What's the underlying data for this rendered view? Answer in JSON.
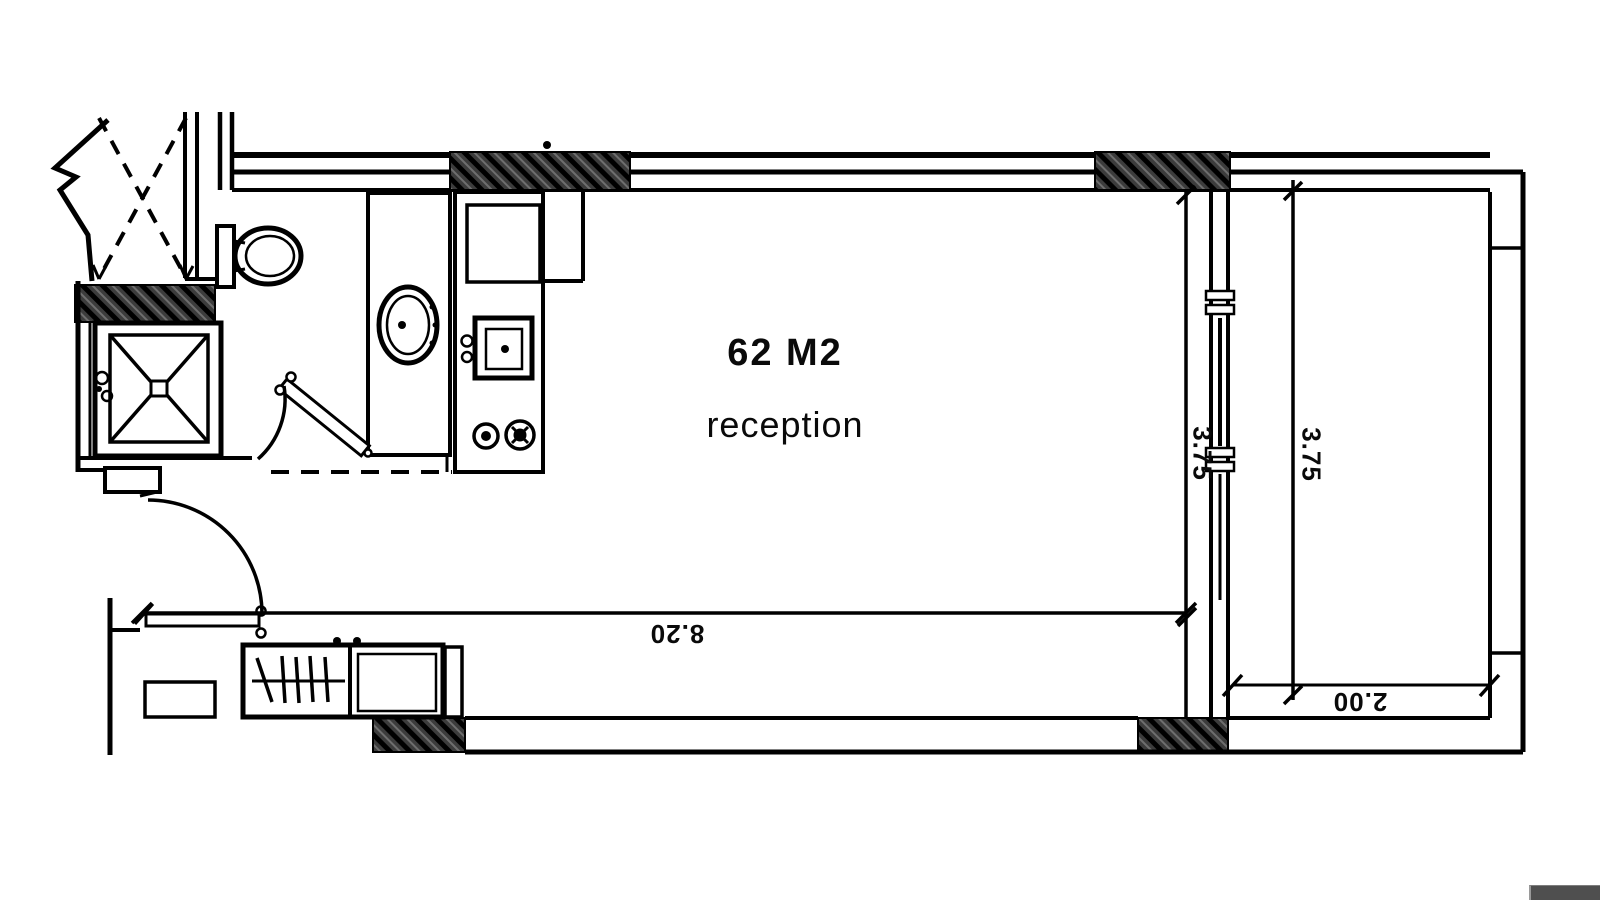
{
  "page": {
    "paper_color": "#ffffff",
    "line_color": "#000000",
    "scrollbar_color": "#4f4f4f"
  },
  "plan": {
    "area_label": "62 M2",
    "room_name": "reception",
    "dimensions": {
      "bottom_width": {
        "value": "8.20",
        "orientation": "upside-down"
      },
      "inner_height": {
        "value": "3.75",
        "orientation": "vertical"
      },
      "outer_height": {
        "value": "3.75",
        "orientation": "vertical"
      },
      "balcony_depth": {
        "value": "2.00",
        "orientation": "upside-down"
      }
    },
    "fixtures": [
      "toilet",
      "washbasin",
      "shower",
      "kitchen-sink",
      "stove-burners",
      "wardrobe",
      "shoe-cabinet",
      "entry-door",
      "bathroom-door",
      "sliding-window",
      "balcony",
      "elevator-shaft"
    ]
  }
}
